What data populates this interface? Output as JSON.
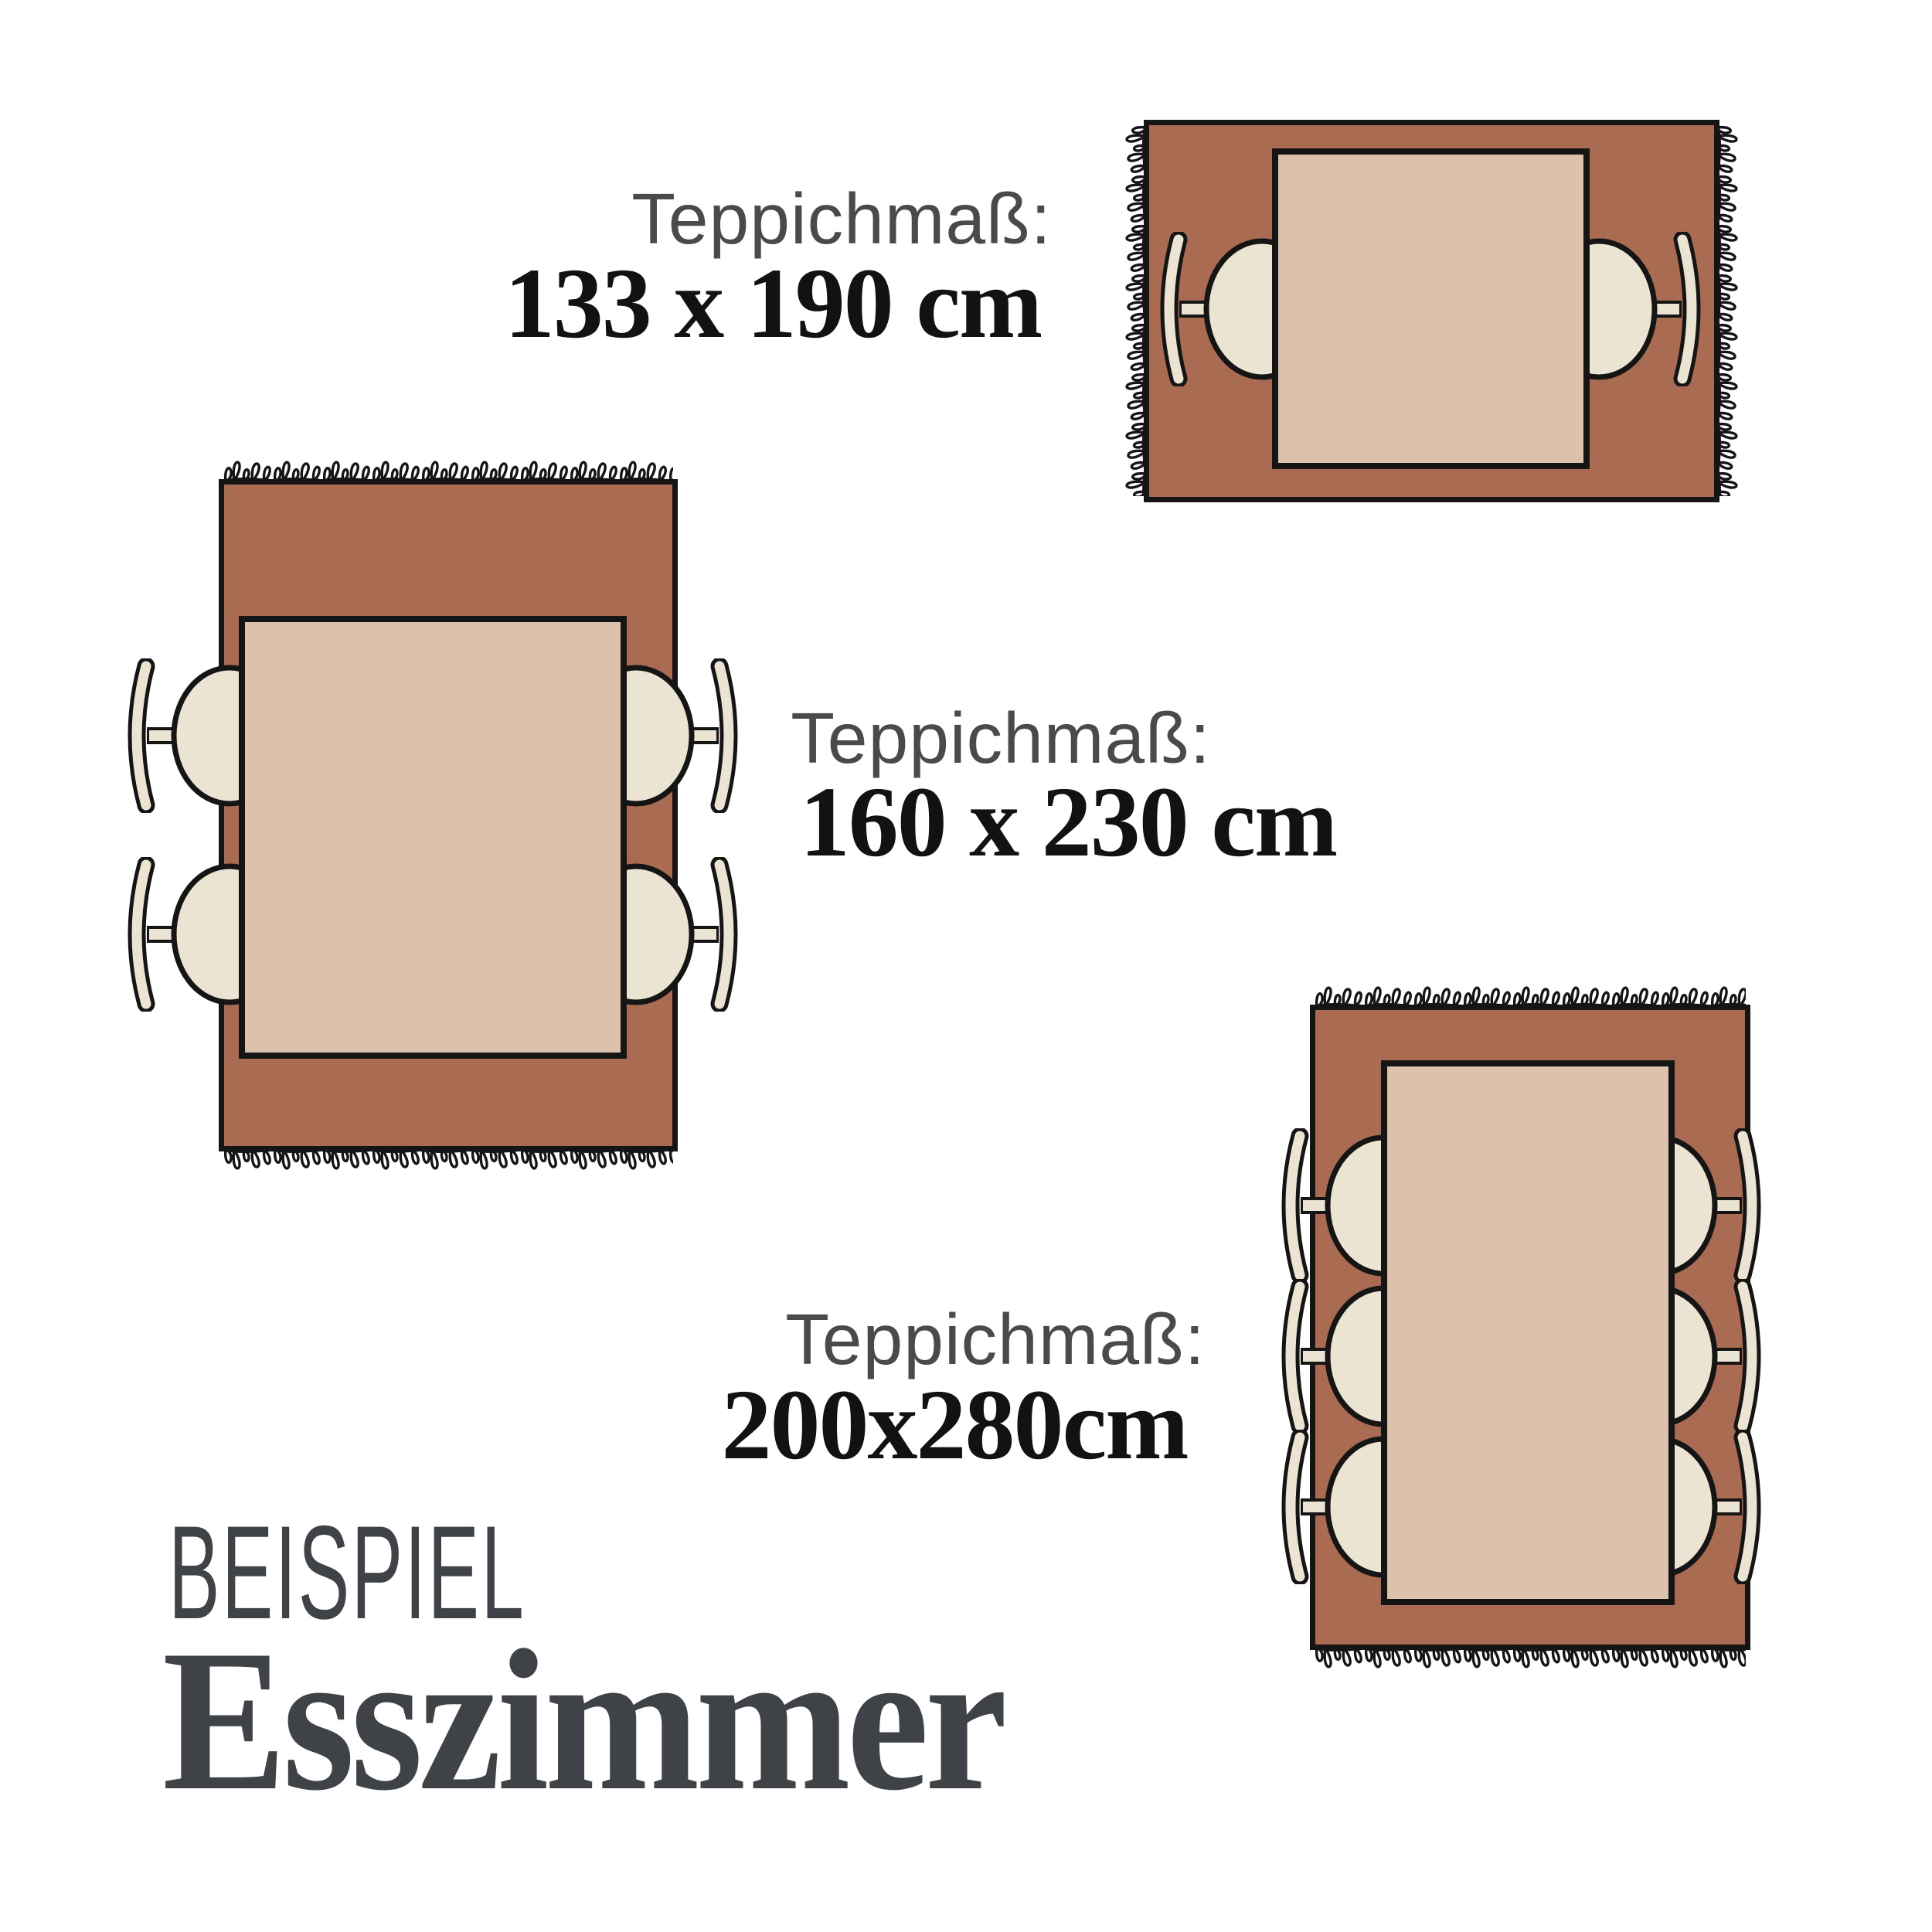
{
  "heading": {
    "eyebrow": "BEISPIEL",
    "title": "Esszimmer"
  },
  "sections": [
    {
      "id": "rug-133x190",
      "label": "Teppichmaß:",
      "size": "133 x 190 cm",
      "chairs": 2,
      "orientation": "landscape"
    },
    {
      "id": "rug-160x230",
      "label": "Teppichmaß:",
      "size": "160 x 230 cm",
      "chairs": 4,
      "orientation": "portrait"
    },
    {
      "id": "rug-200x280",
      "label": "Teppichmaß:",
      "size": "200x280cm",
      "chairs": 6,
      "orientation": "portrait"
    }
  ],
  "colors": {
    "background": "#ffffff",
    "rug_terracotta": "#a96b52",
    "table_tan": "#dcc2ac",
    "chair_cream": "#ece4d2",
    "outline_black": "#151515",
    "label_gray": "#4a4a4a",
    "number_black": "#121212",
    "heading_gray": "#3f4347"
  }
}
